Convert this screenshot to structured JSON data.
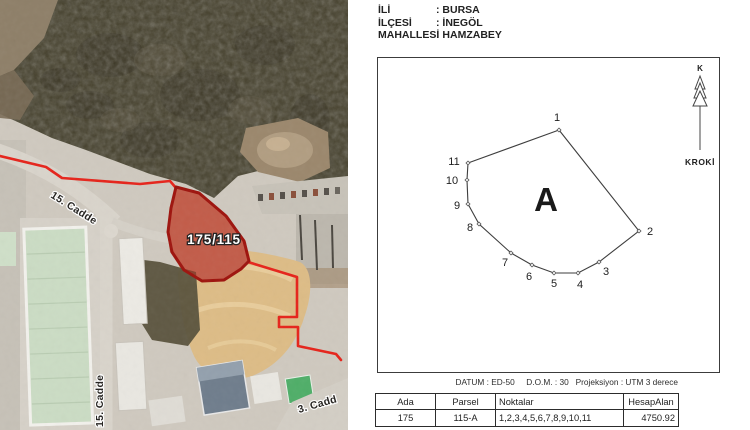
{
  "map": {
    "parcel_label": "175/115",
    "street_label_main": "15. Cadde",
    "street_label_vertical": "15. Cadde",
    "street_label_bottom": "3. Cadd",
    "boundary_color": "#e6231a",
    "parcel_outline_color": "#9e130d"
  },
  "doc": {
    "header_rows": [
      {
        "label": "İLİ",
        "value": ": BURSA"
      },
      {
        "label": "İLÇESİ",
        "value": ": İNEGÖL"
      },
      {
        "label": "MAHALLESİ",
        "value": ": HAMZABEY"
      }
    ],
    "sketch": {
      "north_letter": "K",
      "caption": "KROKİ",
      "area_label": "A",
      "area_label_pos": {
        "x": 168,
        "y": 153
      },
      "vertices": [
        {
          "n": "1",
          "x": 181,
          "y": 72,
          "lx": 179,
          "ly": 63
        },
        {
          "n": "2",
          "x": 261,
          "y": 173,
          "lx": 272,
          "ly": 177
        },
        {
          "n": "3",
          "x": 221,
          "y": 204,
          "lx": 228,
          "ly": 217
        },
        {
          "n": "4",
          "x": 200,
          "y": 215,
          "lx": 202,
          "ly": 230
        },
        {
          "n": "5",
          "x": 176,
          "y": 215,
          "lx": 176,
          "ly": 229
        },
        {
          "n": "6",
          "x": 154,
          "y": 207,
          "lx": 151,
          "ly": 222
        },
        {
          "n": "7",
          "x": 133,
          "y": 195,
          "lx": 127,
          "ly": 208
        },
        {
          "n": "8",
          "x": 101,
          "y": 166,
          "lx": 92,
          "ly": 173
        },
        {
          "n": "9",
          "x": 90,
          "y": 146,
          "lx": 79,
          "ly": 151
        },
        {
          "n": "10",
          "x": 89,
          "y": 122,
          "lx": 74,
          "ly": 126
        },
        {
          "n": "11",
          "x": 90,
          "y": 105,
          "lx": 76,
          "ly": 107
        }
      ]
    },
    "datum_text": "DATUM : ED-50     D.O.M. : 30   Projeksiyon : UTM 3 derece",
    "table": {
      "headers": [
        "Ada",
        "Parsel",
        "Noktalar",
        "HesapAlan"
      ],
      "row": {
        "ada": "175",
        "parsel": "115-A",
        "noktalar": "1,2,3,4,5,6,7,8,9,10,11",
        "hesap_alan": "4750.92"
      }
    }
  }
}
